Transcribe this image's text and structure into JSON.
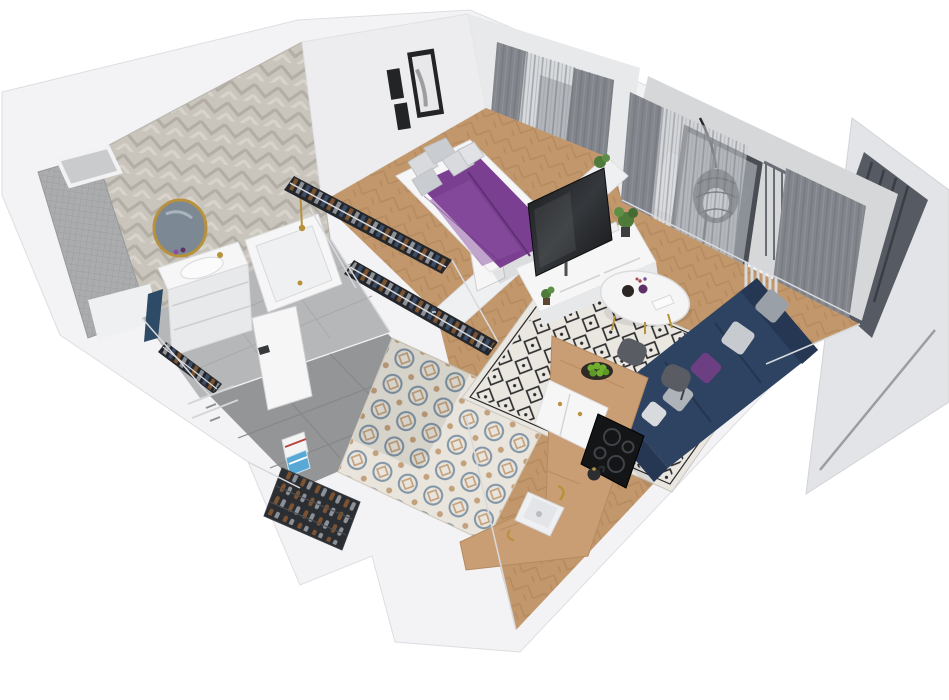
{
  "scene": {
    "title": "3D cutaway floor plan render of a small one-bedroom apartment, isometric top view, white background",
    "style": "photoreal architectural dollhouse render, walls cut open from above"
  },
  "palette": {
    "wall": "#f3f3f5",
    "wallShade": "#e3e4e7",
    "wallEdge": "#d8d9dc",
    "bathFloor": "#b5b7b9",
    "hallTile": "#939597",
    "wood": "#c2976b",
    "woodDark": "#ab8157",
    "counter": "#c99e74",
    "purple": "#7b3f91",
    "purpleDark": "#613077",
    "navy": "#2e4261",
    "navyDark": "#253753",
    "rugBase": "#eae7e1",
    "rugInk": "#2c2c2e",
    "gold": "#b8913d",
    "curtain": "#82868c",
    "sheer": "#d3d6d9",
    "glass": "#565b63",
    "rattan": "#3b3f45",
    "green": "#6fae2f",
    "plantGreen": "#4e7a3a",
    "tileBlue": "#8195a6",
    "tileTan": "#c3a17c",
    "tileBase": "#e9e5dd",
    "chevronA": "#c9c5bd",
    "chevronB": "#b3aea5",
    "mosaic": "#aaacae",
    "cooktop": "#141517",
    "clothesNavy": "#3c4b66",
    "clothesBrown": "#7b5331",
    "clothesGray": "#8d9096"
  },
  "rooms": {
    "bathroom": {
      "label": "Bathroom",
      "items": [
        "herringbone tile wall",
        "round gold mirror",
        "white vanity with sink",
        "purple bottles",
        "navy towel",
        "bathtub with gold faucet",
        "mosaic shower wall",
        "duct shaft"
      ]
    },
    "wardrobe": {
      "label": "Wardrobe corridor",
      "items": [
        "two open clothes racks full of hanging garments",
        "white cabinetry"
      ]
    },
    "hallway": {
      "label": "Hallway",
      "items": [
        "dark gray floor tiles",
        "closet rack with clothes",
        "open white door",
        "stack of books"
      ]
    },
    "entrance": {
      "label": "Entrance nook",
      "items": [
        "shoe rack with shoes"
      ]
    },
    "bedroom": {
      "label": "Bedroom",
      "items": [
        "double bed with purple duvet",
        "gray pillows",
        "three black framed artworks",
        "gray curtains over window"
      ]
    },
    "living_room": {
      "label": "Living room",
      "items": [
        "TV on white sideboard",
        "black and white diamond rug",
        "round white coffee table",
        "navy sofa with gray and purple cushions",
        "two gray stools",
        "potted plants",
        "radiator"
      ]
    },
    "kitchen": {
      "label": "Kitchen",
      "items": [
        "L-shaped wooden counter",
        "black induction cooktop",
        "white sink with gold tap",
        "bowl of green apples",
        "kettle",
        "patterned Moroccan floor tiles",
        "white cabinet fronts with gold handles"
      ]
    },
    "balcony": {
      "label": "Balcony",
      "items": [
        "rattan hanging egg chair",
        "glass balcony door",
        "railing with vertical bars",
        "outdoor rug"
      ]
    },
    "exterior": {
      "label": "Cut-away facade panel",
      "items": [
        "detached exterior wall with dark window band"
      ]
    }
  }
}
